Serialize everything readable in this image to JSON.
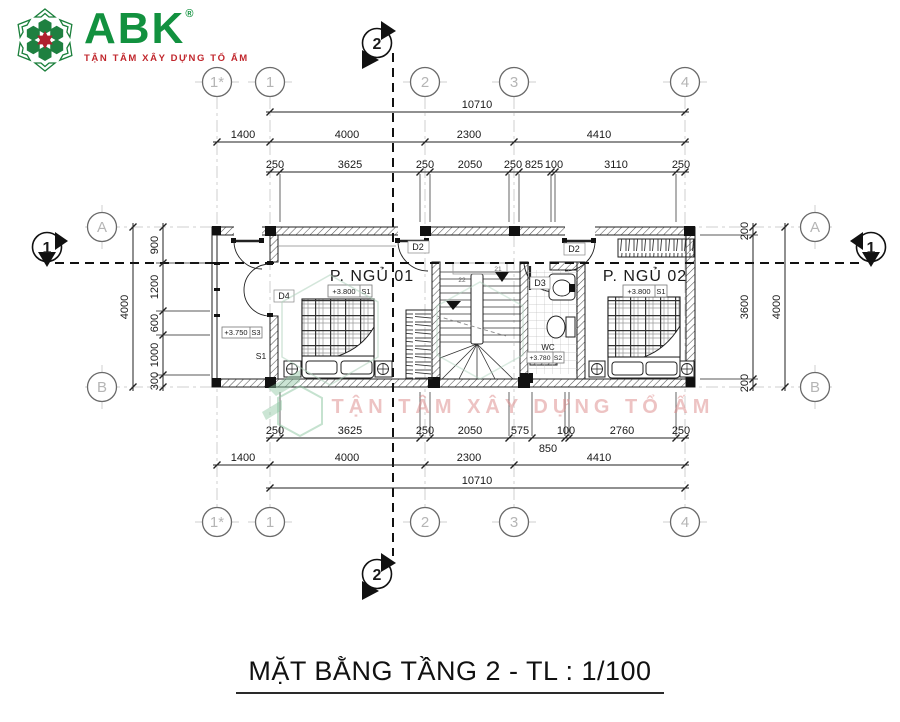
{
  "logo": {
    "name": "ABK",
    "reg": "®",
    "tagline": "TẬN TÂM XÂY DỰNG TỔ ẤM"
  },
  "title": "MẶT BẰNG TẦNG 2 - TL : 1/100",
  "watermark": {
    "tagline": "TẬN TÂM XÂY DỰNG TỔ ẤM"
  },
  "grid": {
    "top": [
      "1*",
      "1",
      "2",
      "3",
      "4"
    ],
    "bottom": [
      "1*",
      "1",
      "2",
      "3",
      "4"
    ],
    "left": [
      "A",
      "B"
    ],
    "right": [
      "A",
      "B"
    ]
  },
  "sections": {
    "top": "2",
    "bottom": "2",
    "left": "1",
    "right": "1"
  },
  "dims": {
    "top": {
      "overall": "10710",
      "bays": [
        "1400",
        "4000",
        "2300",
        "4410"
      ],
      "segments": [
        "250",
        "3625",
        "250",
        "2050",
        "250",
        "825",
        "100",
        "3110",
        "250"
      ]
    },
    "bottom": {
      "segments": [
        "250",
        "3625",
        "250",
        "2050",
        "575",
        "100",
        "2760",
        "250"
      ],
      "offset": "850",
      "bays": [
        "1400",
        "4000",
        "2300",
        "4410"
      ],
      "overall": "10710"
    },
    "left": {
      "overall": "4000",
      "segments": [
        "900",
        "1200",
        "600",
        "1000",
        "300"
      ]
    },
    "right": {
      "overall": "4000",
      "segments": [
        "200",
        "3600",
        "200"
      ]
    }
  },
  "rooms": {
    "bedroom1": {
      "name": "P. NGỦ 01",
      "level": "+3.800",
      "finish": "S1"
    },
    "bedroom2": {
      "name": "P. NGỦ 02",
      "level": "+3.800",
      "finish": "S1"
    },
    "wc": {
      "name": "WC",
      "level": "+3.780",
      "finish": "S2"
    },
    "balcony": {
      "level": "+3.750",
      "finish": "S3",
      "floor_tag": "S1"
    }
  },
  "doors": {
    "d2a": "D2",
    "d2b": "D2",
    "d3": "D3",
    "d4": "D4"
  },
  "stair": {
    "step_a": "21",
    "step_b": "22"
  }
}
